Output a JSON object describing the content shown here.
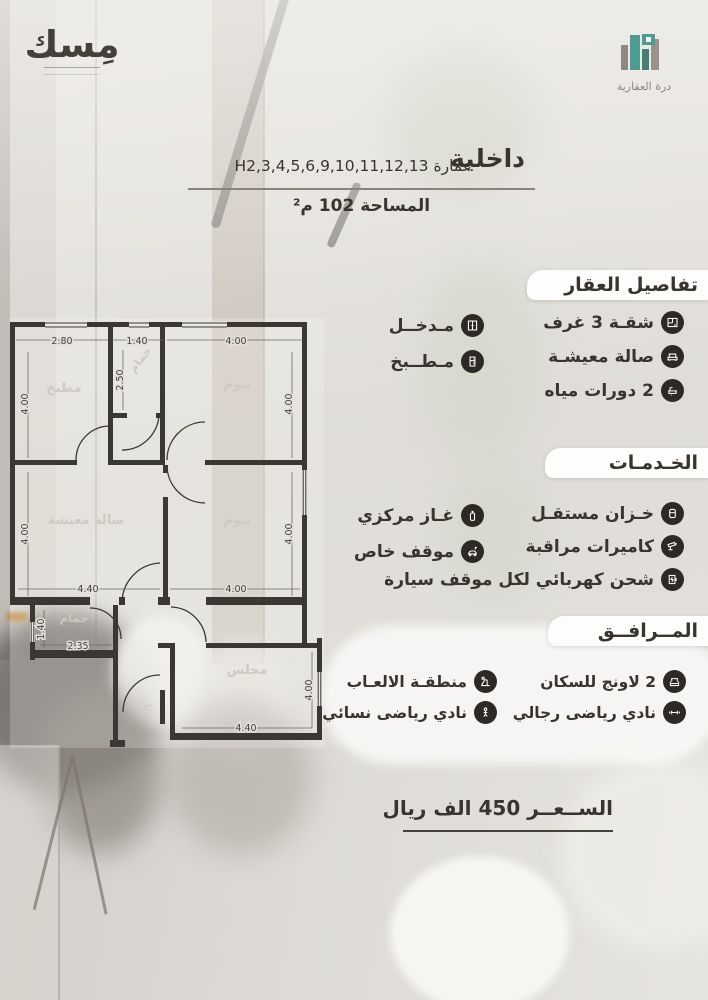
{
  "brand": {
    "misk_logo_text": "مِسك",
    "durrah_logo_text": "درة العقارية",
    "accent_teal": "#4d9b91",
    "icon_circle_color": "#2d2926"
  },
  "header": {
    "type_label": "داخلية",
    "building_label": "عمارة H2,3,4,5,6,9,10,11,12,13",
    "area_label": "المساحة 102 م²"
  },
  "property_details": {
    "title": "تفاصيل العقار",
    "right_items": [
      {
        "label": "شقـة 3 غرف",
        "icon": "apartment-rooms-icon"
      },
      {
        "label": "صالة معيشـة",
        "icon": "living-hall-icon"
      },
      {
        "label": "2 دورات مياه",
        "icon": "bathrooms-icon"
      }
    ],
    "left_items": [
      {
        "label": "مـدخــل",
        "icon": "entrance-icon"
      },
      {
        "label": "مـطــبخ",
        "icon": "kitchen-icon"
      }
    ]
  },
  "services": {
    "title": "الخـدمـات",
    "right_items": [
      {
        "label": "خـزان مستقـل",
        "icon": "water-tank-icon"
      },
      {
        "label": "كاميرات مراقبة",
        "icon": "cctv-camera-icon"
      },
      {
        "label": "شحن كهربائي لكل موقف سيارة",
        "icon": "ev-charging-icon"
      }
    ],
    "left_items": [
      {
        "label": "غـاز مركزي",
        "icon": "central-gas-icon"
      },
      {
        "label": "موقف خاص",
        "icon": "private-parking-icon"
      }
    ]
  },
  "amenities": {
    "title": "المــرافــق",
    "right_items": [
      {
        "label": "2 لاونج للسكان",
        "icon": "residents-lounge-icon"
      },
      {
        "label": "نادي رياضى رجالي",
        "icon": "mens-gym-icon"
      }
    ],
    "left_items": [
      {
        "label": "منطقـة الالعـاب",
        "icon": "playground-icon"
      },
      {
        "label": "نادي رياضى نسائي",
        "icon": "womens-gym-icon"
      }
    ]
  },
  "price": {
    "label": "الســعــر 450 الف ريال"
  },
  "plan": {
    "rooms": {
      "kitchen": "مطبخ",
      "bath_top": "حمام",
      "bedroom1": "نـوم",
      "living": "صالة معيشة",
      "bedroom2": "نـوم",
      "bath_bottom": "حمام",
      "majlis": "مجلس",
      "entry": "مدخل"
    },
    "dims": {
      "kitchen_w": "2.80",
      "bath_top_w": "1.40",
      "bedroom1_w": "4.00",
      "kitchen_h": "4.00",
      "bath_top_h": "2.50",
      "bedroom1_h": "4.00",
      "living_h": "4.00",
      "bedroom2_h": "4.00",
      "living_w": "4.40",
      "bedroom2_w": "4.00",
      "bath_bottom_h": "1.40",
      "bath_bottom_w": "2.35",
      "majlis_h": "4.00",
      "majlis_w": "4.40"
    }
  }
}
